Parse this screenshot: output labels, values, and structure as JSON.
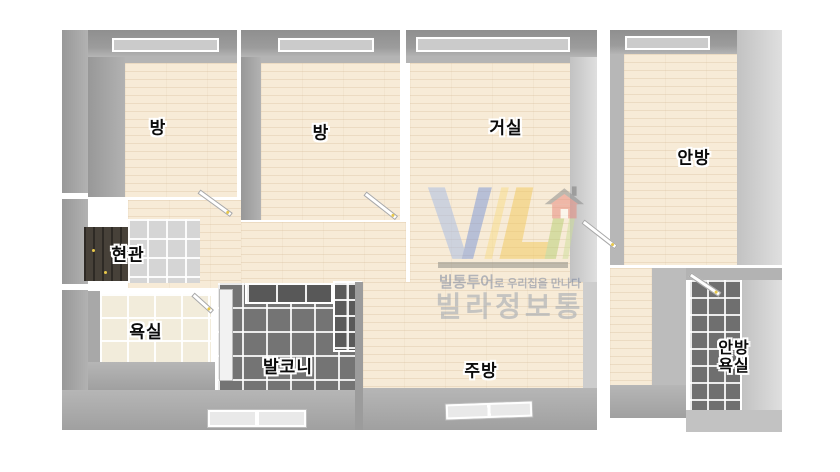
{
  "meta": {
    "type": "apartment-floorplan",
    "view": "3d-top-down-render"
  },
  "rooms": {
    "bedroom1": {
      "label": "방"
    },
    "bedroom2": {
      "label": "방"
    },
    "living": {
      "label": "거실"
    },
    "master": {
      "label": "안방"
    },
    "entrance": {
      "label": "현관"
    },
    "bathroom": {
      "label": "욕실"
    },
    "balcony": {
      "label": "발코니"
    },
    "kitchen": {
      "label": "주방"
    },
    "master_bathroom": {
      "label_line1": "안방",
      "label_line2": "욕실"
    }
  },
  "watermark": {
    "logo": "VLI",
    "tagline_brand": "빌통투어",
    "tagline_rest": "로 우리집을 만나다",
    "brand": "빌라정보통"
  },
  "palette": {
    "wall_dark": "#969696",
    "wall_mid": "#a9a9a9",
    "wall_light": "#c9c9c9",
    "floor_wood": "#f7ebd7",
    "tile_dark": "#747474",
    "tile_cream": "#f2ecdb",
    "tile_entry": "#d5d5d5",
    "entry_door": "#474139",
    "window_glass": "#cbcbcb",
    "logo_lightblue": "#a8bce4",
    "logo_blue": "#7e97d6",
    "logo_yellow": "#f2c95e",
    "logo_light_yellow": "#f7dc8a",
    "logo_green": "#b8cf74",
    "logo_red": "#e8897c",
    "watermark_text": "#99a2ad"
  }
}
